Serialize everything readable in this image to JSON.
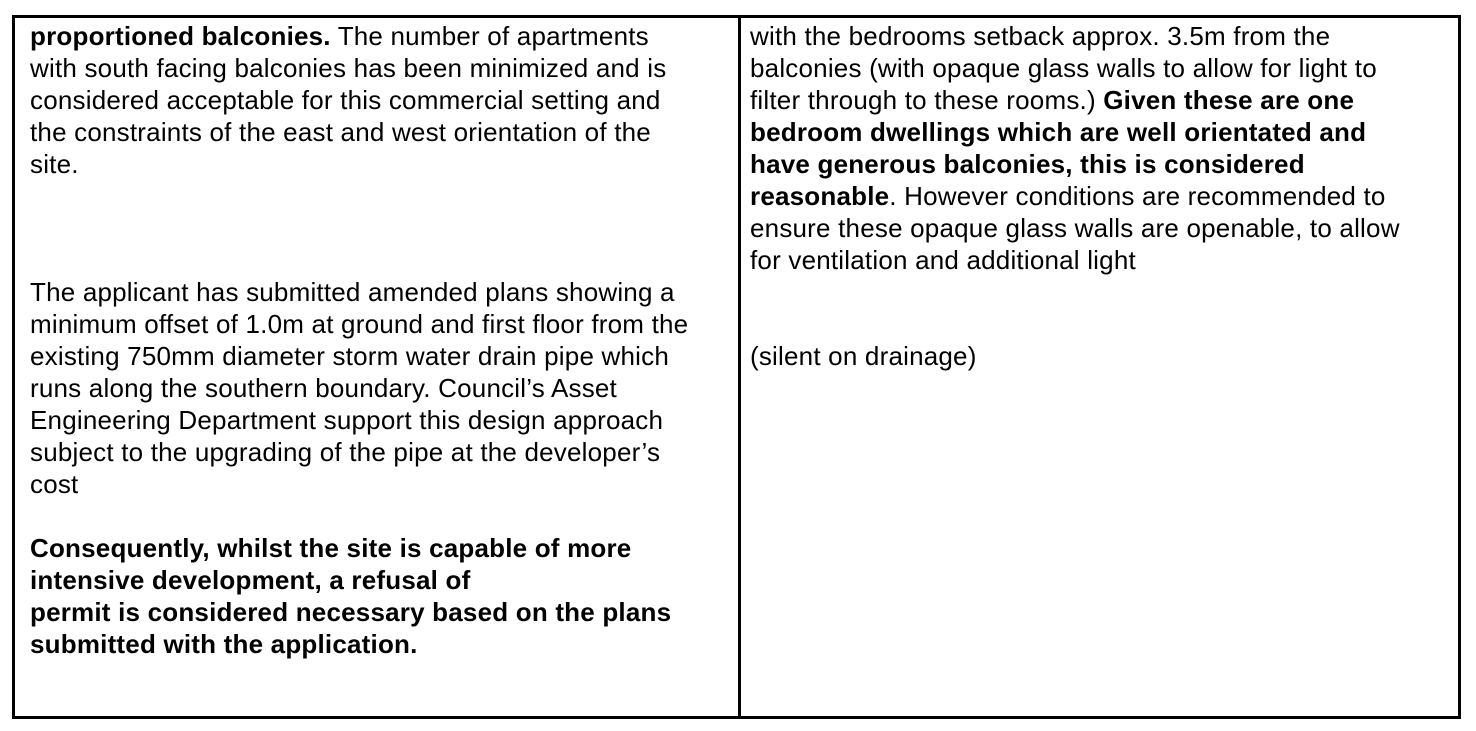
{
  "document": {
    "type": "planning-assessment-table",
    "colors": {
      "text": "#000000",
      "border": "#000000",
      "background": "#ffffff"
    },
    "table": {
      "left_cell": {
        "lines": [
          {
            "runs": [
              {
                "text": "proportioned balconies.",
                "bold": true
              },
              {
                "text": " The number of apartments",
                "bold": false
              }
            ]
          },
          {
            "runs": [
              {
                "text": "with south facing balconies has been minimized and is",
                "bold": false
              }
            ]
          },
          {
            "runs": [
              {
                "text": "considered acceptable for this commercial setting and",
                "bold": false
              }
            ]
          },
          {
            "runs": [
              {
                "text": "the constraints of the east and west orientation of the",
                "bold": false
              }
            ]
          },
          {
            "runs": [
              {
                "text": "site.",
                "bold": false
              }
            ]
          },
          {
            "runs": []
          },
          {
            "runs": []
          },
          {
            "runs": []
          },
          {
            "runs": [
              {
                "text": "The applicant has submitted amended plans showing a",
                "bold": false
              }
            ]
          },
          {
            "runs": [
              {
                "text": "minimum offset of 1.0m at ground and first floor from the",
                "bold": false
              }
            ]
          },
          {
            "runs": [
              {
                "text": "existing 750mm diameter storm water drain pipe which",
                "bold": false
              }
            ]
          },
          {
            "runs": [
              {
                "text": "runs along the southern boundary. Council’s Asset",
                "bold": false
              }
            ]
          },
          {
            "runs": [
              {
                "text": "Engineering Department support this design approach",
                "bold": false
              }
            ]
          },
          {
            "runs": [
              {
                "text": "subject to the upgrading of the pipe at the developer’s",
                "bold": false
              }
            ]
          },
          {
            "runs": [
              {
                "text": "cost",
                "bold": false
              }
            ]
          },
          {
            "runs": []
          },
          {
            "runs": [
              {
                "text": "Consequently, whilst the site is capable of more",
                "bold": true
              }
            ]
          },
          {
            "runs": [
              {
                "text": "intensive development, a refusal of",
                "bold": true
              }
            ]
          },
          {
            "runs": [
              {
                "text": "permit is considered necessary based on the plans",
                "bold": true
              }
            ]
          },
          {
            "runs": [
              {
                "text": "submitted with the application.",
                "bold": true
              }
            ]
          }
        ]
      },
      "right_cell": {
        "lines": [
          {
            "runs": [
              {
                "text": "with the bedrooms setback approx. 3.5m from the",
                "bold": false
              }
            ]
          },
          {
            "runs": [
              {
                "text": "balconies (with opaque glass walls to allow for light to",
                "bold": false
              }
            ]
          },
          {
            "runs": [
              {
                "text": "filter through to these rooms.) ",
                "bold": false
              },
              {
                "text": "Given these are one",
                "bold": true
              }
            ]
          },
          {
            "runs": [
              {
                "text": "bedroom dwellings which are well orientated and",
                "bold": true
              }
            ]
          },
          {
            "runs": [
              {
                "text": "have generous balconies, this is considered",
                "bold": true
              }
            ]
          },
          {
            "runs": [
              {
                "text": "reasonable",
                "bold": true
              },
              {
                "text": ". However conditions are recommended to",
                "bold": false
              }
            ]
          },
          {
            "runs": [
              {
                "text": "ensure these opaque glass walls are openable, to allow",
                "bold": false
              }
            ]
          },
          {
            "runs": [
              {
                "text": "for ventilation and additional light",
                "bold": false
              }
            ]
          },
          {
            "runs": []
          },
          {
            "runs": []
          },
          {
            "runs": [
              {
                "text": "(silent on drainage)",
                "bold": false
              }
            ]
          }
        ]
      }
    }
  }
}
